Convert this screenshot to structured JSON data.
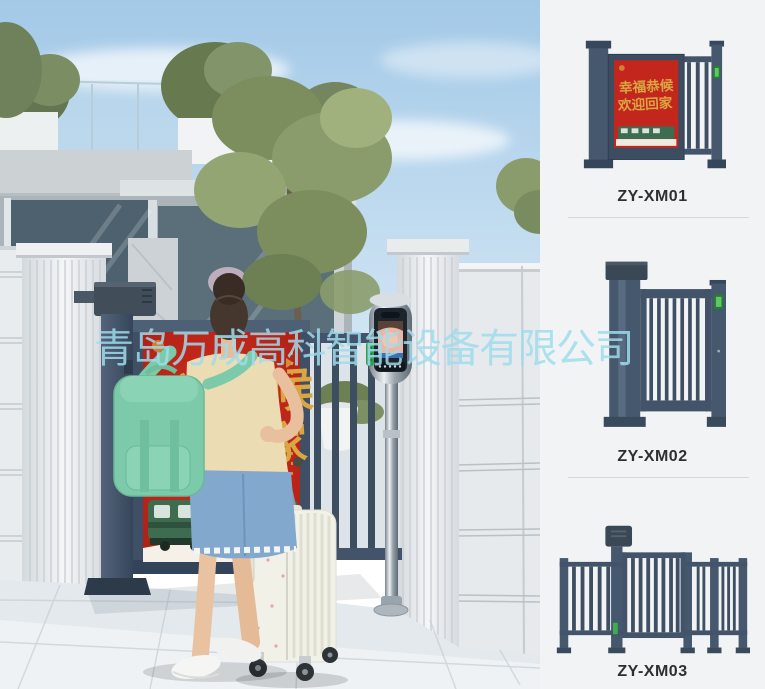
{
  "watermark": {
    "text": "青岛万成高科智能设备有限公司",
    "color": "#9fdcec"
  },
  "poster": {
    "line1": "幸福恭候",
    "line2": "欢迎回家",
    "bg_color": "#c3261c",
    "gold_color": "#d9a642",
    "train_color": "#3d6c51"
  },
  "panel": {
    "bg_color": "#f2f3f4",
    "products": [
      {
        "label": "ZY-XM01",
        "type": "advertising small gate"
      },
      {
        "label": "ZY-XM02",
        "type": "vertical bar small gate"
      },
      {
        "label": "ZY-XM03",
        "type": "fence gate with center door"
      }
    ]
  },
  "colors": {
    "gate_frame": "#44556a",
    "sky_top": "#a3c9e7",
    "backpack_mint": "#7ccaaa",
    "denim": "#83a8cd",
    "keypad_green": "#2f9e52",
    "pavement": "#e3e9ed"
  }
}
